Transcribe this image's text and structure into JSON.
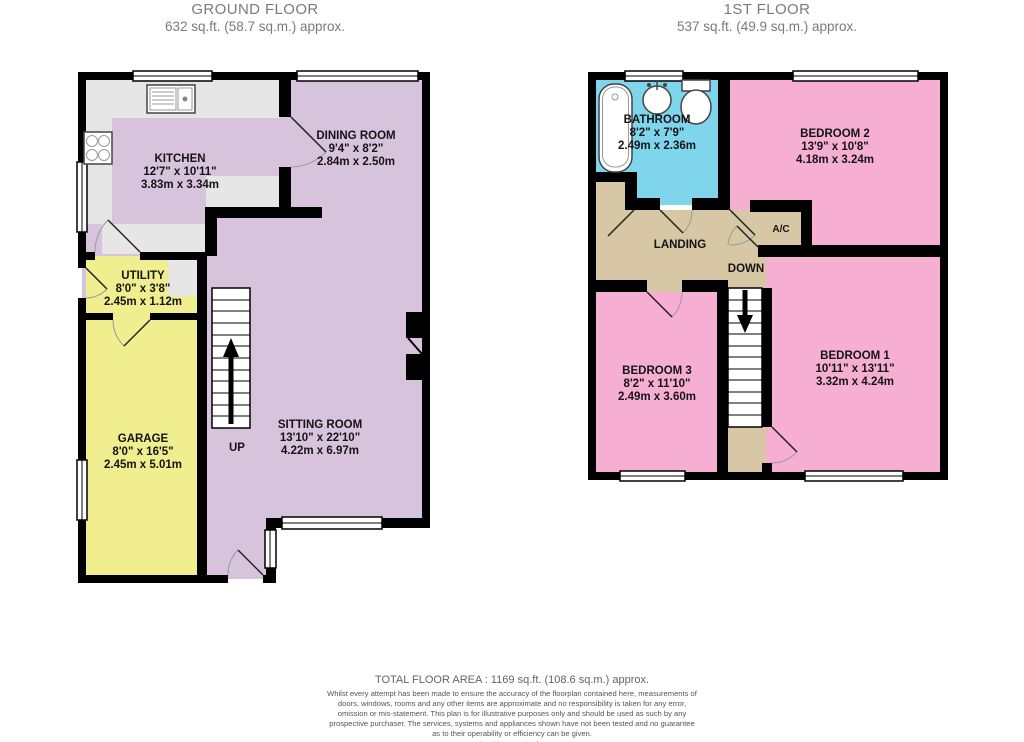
{
  "floors": [
    {
      "title": "GROUND FLOOR",
      "area": "632 sq.ft. (58.7 sq.m.) approx."
    },
    {
      "title": "1ST FLOOR",
      "area": "537 sq.ft. (49.9 sq.m.) approx."
    }
  ],
  "rooms": {
    "kitchen": {
      "name": "KITCHEN",
      "imperial": "12'7\" x 10'11\"",
      "metric": "3.83m x 3.34m"
    },
    "dining": {
      "name": "DINING ROOM",
      "imperial": "9'4\" x 8'2\"",
      "metric": "2.84m x 2.50m"
    },
    "utility": {
      "name": "UTILITY",
      "imperial": "8'0\" x 3'8\"",
      "metric": "2.45m x 1.12m"
    },
    "garage": {
      "name": "GARAGE",
      "imperial": "8'0\" x 16'5\"",
      "metric": "2.45m x 5.01m"
    },
    "sitting": {
      "name": "SITTING ROOM",
      "imperial": "13'10\" x 22'10\"",
      "metric": "4.22m x 6.97m"
    },
    "bathroom": {
      "name": "BATHROOM",
      "imperial": "8'2\" x 7'9\"",
      "metric": "2.49m x 2.36m"
    },
    "bedroom2": {
      "name": "BEDROOM 2",
      "imperial": "13'9\" x 10'8\"",
      "metric": "4.18m x 3.24m"
    },
    "bedroom3": {
      "name": "BEDROOM 3",
      "imperial": "8'2\" x 11'10\"",
      "metric": "2.49m x 3.60m"
    },
    "bedroom1": {
      "name": "BEDROOM 1",
      "imperial": "10'11\" x 13'11\"",
      "metric": "3.32m x 4.24m"
    },
    "landing": {
      "name": "LANDING"
    },
    "ac": {
      "name": "A/C"
    }
  },
  "stairs": {
    "up": "UP",
    "down": "DOWN"
  },
  "footer": {
    "total": "TOTAL FLOOR AREA : 1169 sq.ft. (108.6 sq.m.) approx.",
    "disclaimer": "Whilst every attempt has been made to ensure the accuracy of the floorplan contained here, measurements of doors, windows, rooms and any other items are approximate and no responsibility is taken for any error, omission or mis-statement. This plan is for illustrative purposes only and should be used as such by any prospective purchaser. The services, systems and appliances shown have not been tested and no guarantee as to their operability or efficiency can be given.",
    "credit": "Made with Metropix ©2021"
  },
  "colors": {
    "wall": "#000000",
    "lilac": "#d8c3dc",
    "yellow": "#f0ee8f",
    "pink": "#f6afd3",
    "cyan": "#7fd5ec",
    "tan": "#d8c7a5",
    "counter": "#e6e6e6",
    "title_gray": "#7b7b7b"
  }
}
